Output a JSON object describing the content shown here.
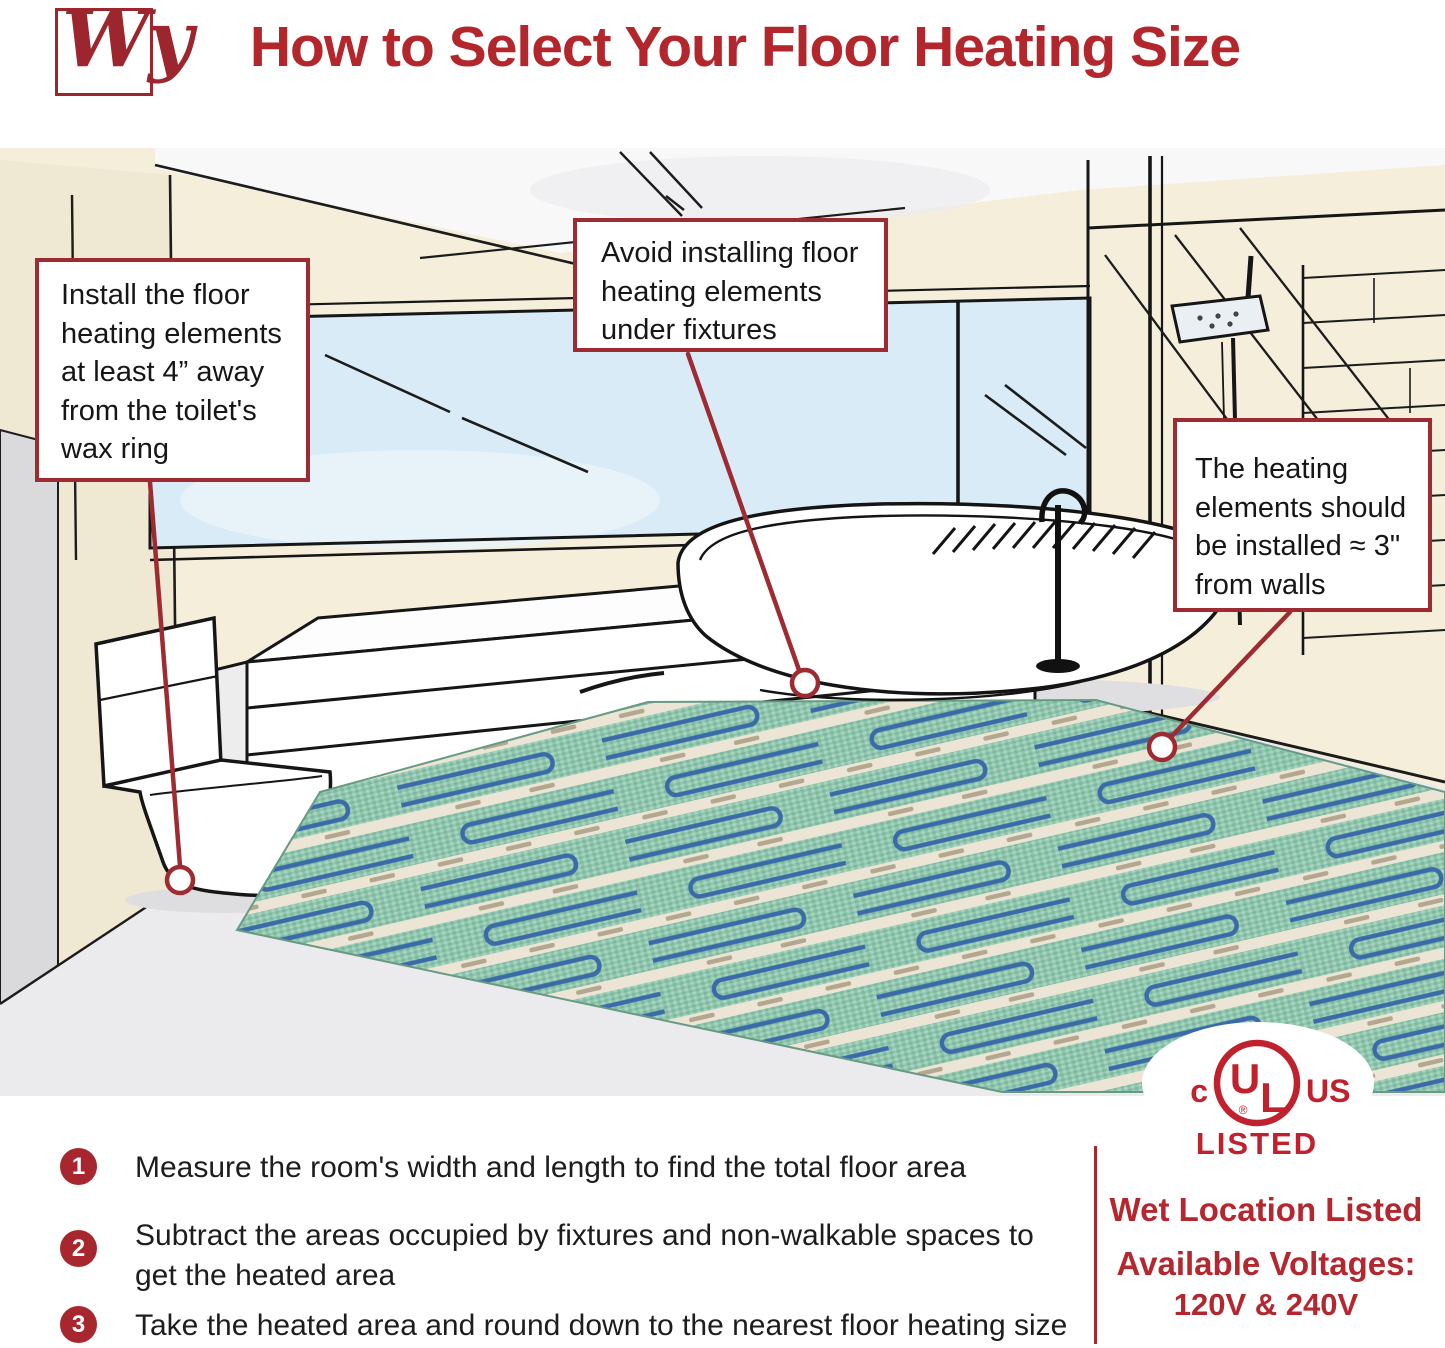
{
  "header": {
    "logo_text": "Wy",
    "title": "How to Select Your Floor Heating Size"
  },
  "callouts": {
    "toilet": "Install the floor heating elements at least 4” away from the toilet's wax ring",
    "fixtures": "Avoid installing floor heating elements under fixtures",
    "walls": "The heating elements should be installed ≈ 3\" from walls"
  },
  "steps": [
    {
      "number": "1",
      "text": "Measure the room's width and length to find the total floor area"
    },
    {
      "number": "2",
      "text": "Subtract the areas occupied by fixtures and non-walkable spaces to\nget the heated area"
    },
    {
      "number": "3",
      "text": "Take the heated area and round down to the nearest floor heating size"
    }
  ],
  "certification": {
    "ul_prefix": "c",
    "ul_letter_u": "U",
    "ul_letter_l": "L",
    "ul_registered": "®",
    "ul_suffix": "US",
    "listed_label": "LISTED",
    "wet_location": "Wet Location Listed",
    "voltages_label": "Available Voltages:",
    "voltages_value": "120V & 240V"
  },
  "colors": {
    "accent_red": "#9d2b31",
    "title_red": "#b2262c",
    "ul_red": "#c1202d",
    "step_badge_red": "#a8272e",
    "wall_cream": "#f4eedb",
    "window_blue": "#d9ebf6",
    "mat_green": "#8fc6ad",
    "mat_tape": "#ece5d5",
    "cable_blue": "#3a6ba8",
    "floor_gray": "#ebebed"
  }
}
